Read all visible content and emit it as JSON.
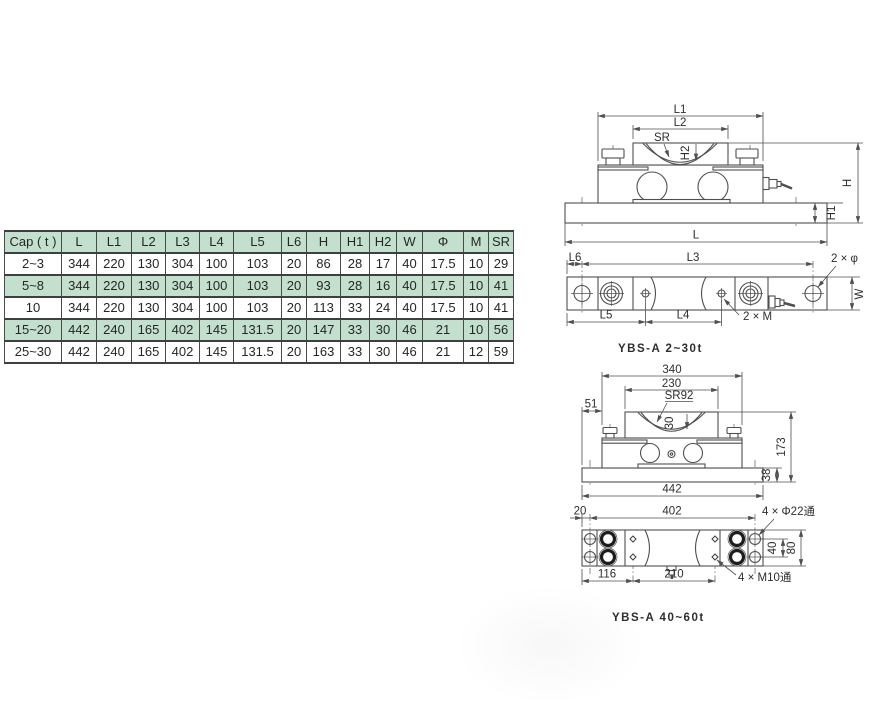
{
  "table": {
    "headers": [
      "Cap ( t )",
      "L",
      "L1",
      "L2",
      "L3",
      "L4",
      "L5",
      "L6",
      "H",
      "H1",
      "H2",
      "W",
      "Φ",
      "M",
      "SR"
    ],
    "rows": [
      [
        "2~3",
        "344",
        "220",
        "130",
        "304",
        "100",
        "103",
        "20",
        "86",
        "28",
        "17",
        "40",
        "17.5",
        "10",
        "29"
      ],
      [
        "5~8",
        "344",
        "220",
        "130",
        "304",
        "100",
        "103",
        "20",
        "93",
        "28",
        "16",
        "40",
        "17.5",
        "10",
        "41"
      ],
      [
        "10",
        "344",
        "220",
        "130",
        "304",
        "100",
        "103",
        "20",
        "113",
        "33",
        "24",
        "40",
        "17.5",
        "10",
        "41"
      ],
      [
        "15~20",
        "442",
        "240",
        "165",
        "402",
        "145",
        "131.5",
        "20",
        "147",
        "33",
        "30",
        "46",
        "21",
        "10",
        "56"
      ],
      [
        "25~30",
        "442",
        "240",
        "165",
        "402",
        "145",
        "131.5",
        "20",
        "163",
        "33",
        "30",
        "46",
        "21",
        "12",
        "59"
      ]
    ]
  },
  "drawings": {
    "small": {
      "title": "YBS-A 2~30t",
      "front": {
        "l1": "L1",
        "l2": "L2",
        "sr": "SR",
        "h2": "H2",
        "h": "H",
        "h1": "H1",
        "l": "L"
      },
      "top": {
        "l6": "L6",
        "l3": "L3",
        "phi": "2 × φ",
        "w": "W",
        "l5": "L5",
        "l4": "L4",
        "m": "2 × M"
      }
    },
    "large": {
      "title": "YBS-A 40~60t",
      "front": {
        "w1": "340",
        "w2": "230",
        "sr": "SR92",
        "d30": "30",
        "d51": "51",
        "h": "173",
        "hb": "38",
        "wb": "442"
      },
      "bottom": {
        "d20": "20",
        "d402": "402",
        "phi": "4 × Φ22通",
        "d40": "40",
        "d80": "80",
        "m": "4 × M10通",
        "d116": "116",
        "d210": "210"
      }
    }
  },
  "colors": {
    "accent_green": "#00a651",
    "table_green": "#c3e0cf",
    "line_gray": "#4f4f4f"
  }
}
